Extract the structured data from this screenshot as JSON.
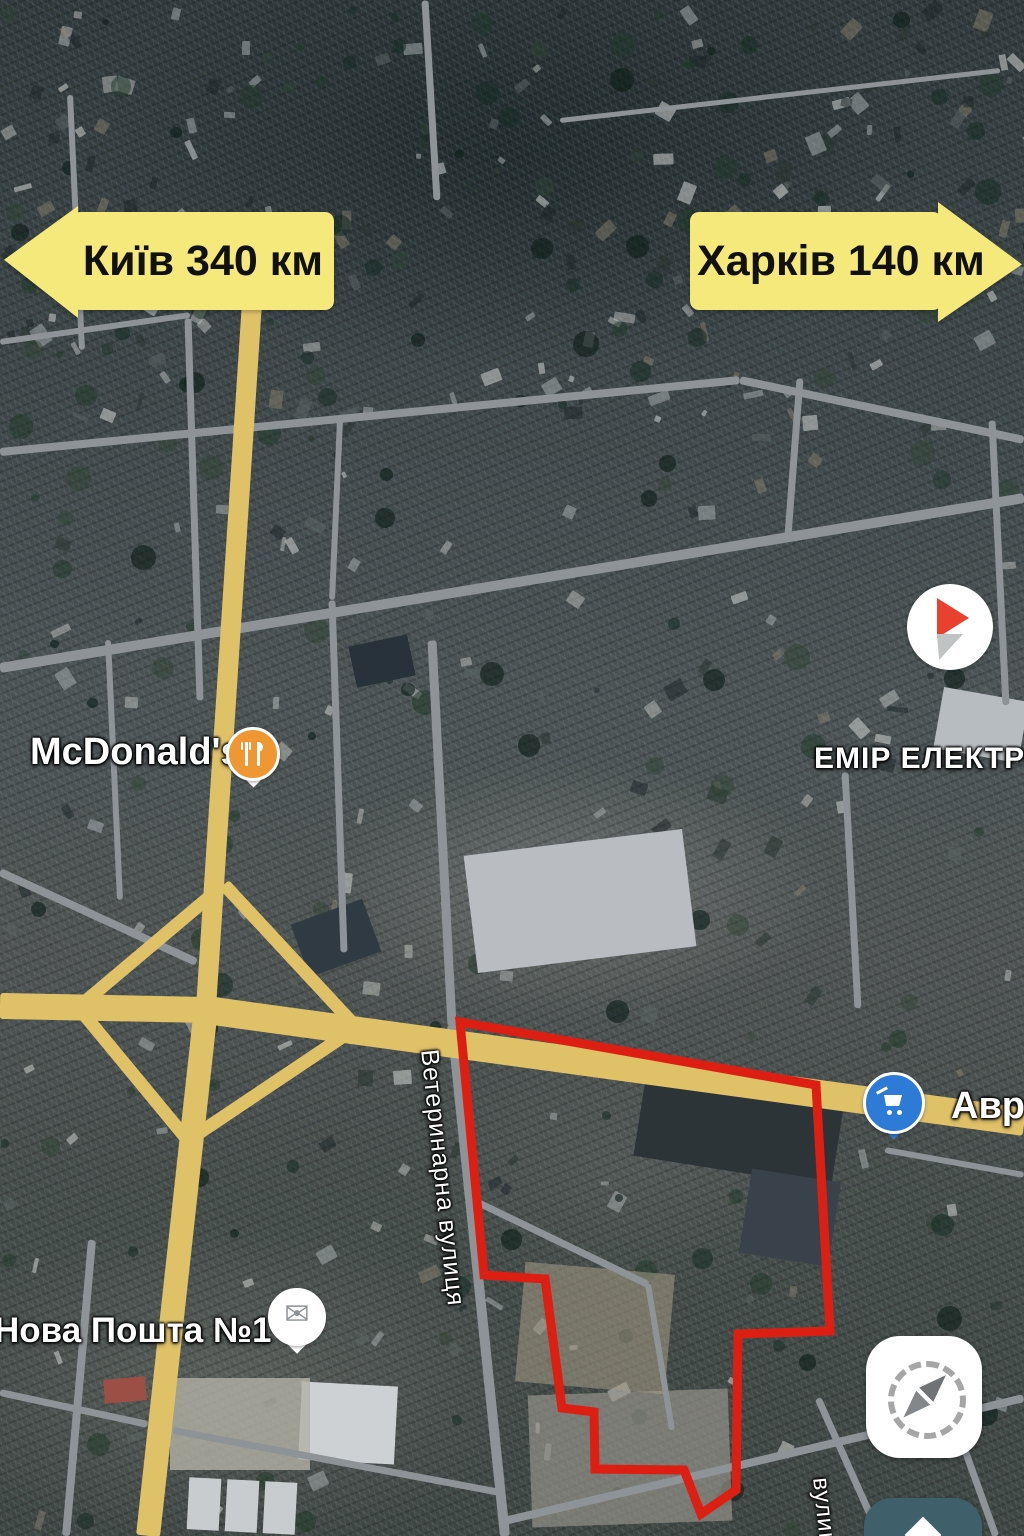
{
  "signs": {
    "left": {
      "label": "Київ 340 км",
      "direction": "left"
    },
    "right": {
      "label": "Харків 140 км",
      "direction": "right"
    }
  },
  "poi": {
    "mcdonalds": {
      "label": "McDonald's",
      "icon": "restaurant-icon",
      "color": "#ef9733"
    },
    "emir_elektro": {
      "label": "ЕМІР ЕЛЕКТРО"
    },
    "nova_poshta": {
      "label": "Нова Пошта №1",
      "icon": "envelope-icon",
      "envelope_glyph": "✉"
    },
    "avrora": {
      "label": "Аврора",
      "icon": "cart-icon",
      "color": "#2e7ad7"
    }
  },
  "streets": {
    "veterynarna": "Ветеринарна вулиця",
    "bottom_right": "вулиця"
  },
  "highlight": {
    "points": "460,1022 816,1085 830,1331 738,1334 736,1490 701,1514 684,1470 595,1469 594,1412 562,1408 545,1279 484,1275",
    "color": "#dd1f13"
  },
  "colors": {
    "sign_yellow": "#f6e97b",
    "sign_text": "#111111",
    "highlight_red": "#dd1f13",
    "road_yellow": "#dfc168",
    "road_gray": "#8e9397",
    "marker_orange": "#ef9733",
    "marker_blue": "#2e7ad7"
  }
}
